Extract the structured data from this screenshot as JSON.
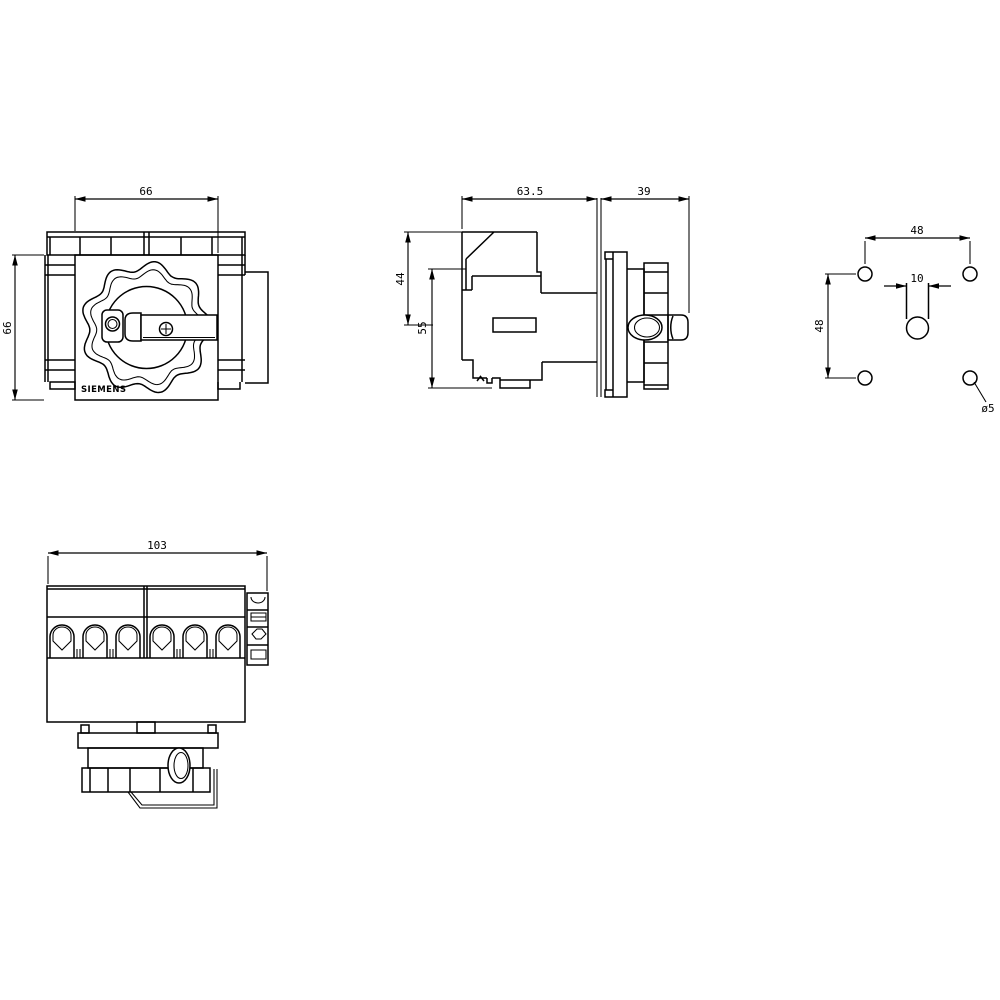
{
  "page": {
    "background": "#ffffff",
    "line_color": "#000000",
    "description": "Dimension drawing of a switch disconnector with rotary handle, four orthographic views"
  },
  "views": {
    "front": {
      "name": "front-view",
      "dim_width": "66",
      "dim_height": "66",
      "brand": "SIEMENS"
    },
    "side": {
      "name": "side-view",
      "dim_body_depth": "63.5",
      "dim_handle_depth": "39",
      "dim_shaft_offset": "44",
      "dim_body_height": "55"
    },
    "drill": {
      "name": "drilling-pattern-view",
      "dim_hole_spacing_horizontal": "48",
      "dim_hole_spacing_vertical": "48",
      "dim_shaft_slot_width": "10",
      "hole_diameter_label": "ø5"
    },
    "bottom": {
      "name": "top-view",
      "dim_width": "103"
    }
  }
}
